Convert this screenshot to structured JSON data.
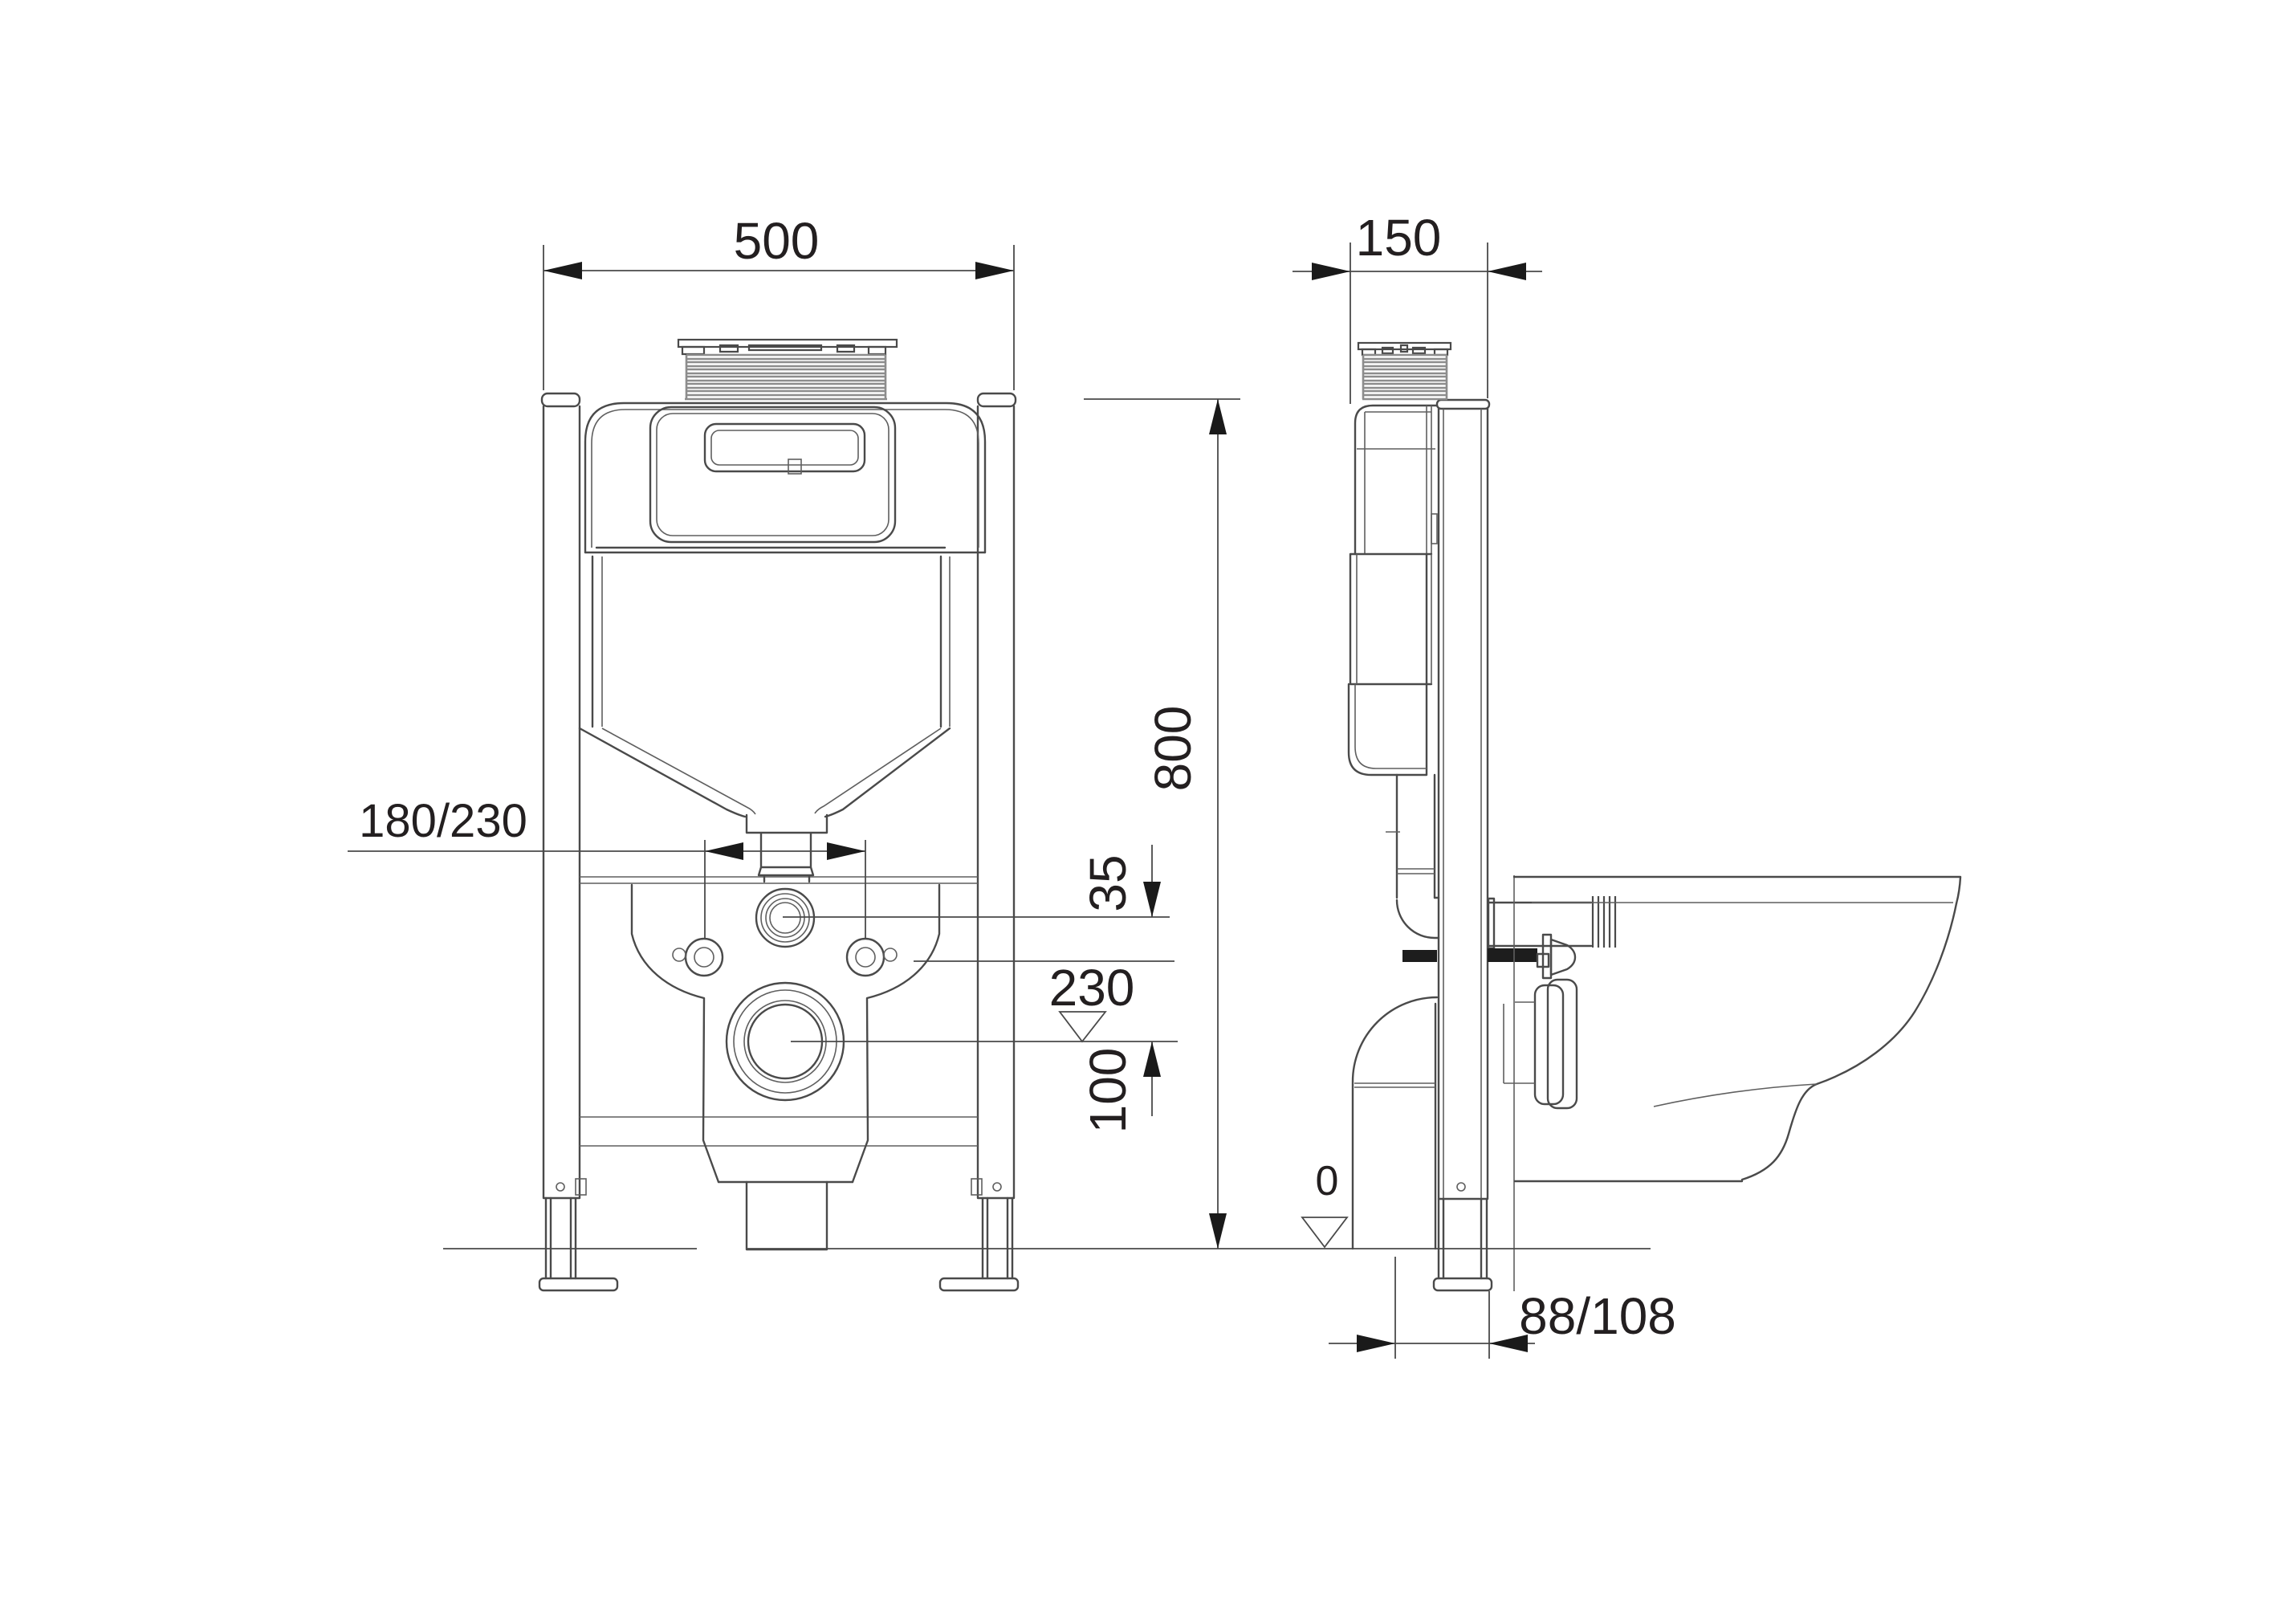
{
  "colors": {
    "background": "#ffffff",
    "line": "#4a4a4a",
    "text": "#231f20",
    "arrow": "#1a1a1a",
    "bellows": "#8d8d8d"
  },
  "dimensions": {
    "width": "500",
    "depth": "150",
    "height": "800",
    "fixing_spacing": "180/230",
    "inlet_offset": "35",
    "outlet_level": "230",
    "fixing_to_outlet": "100",
    "floor_level": "0",
    "drain_axis_to_wall": "88/108"
  }
}
